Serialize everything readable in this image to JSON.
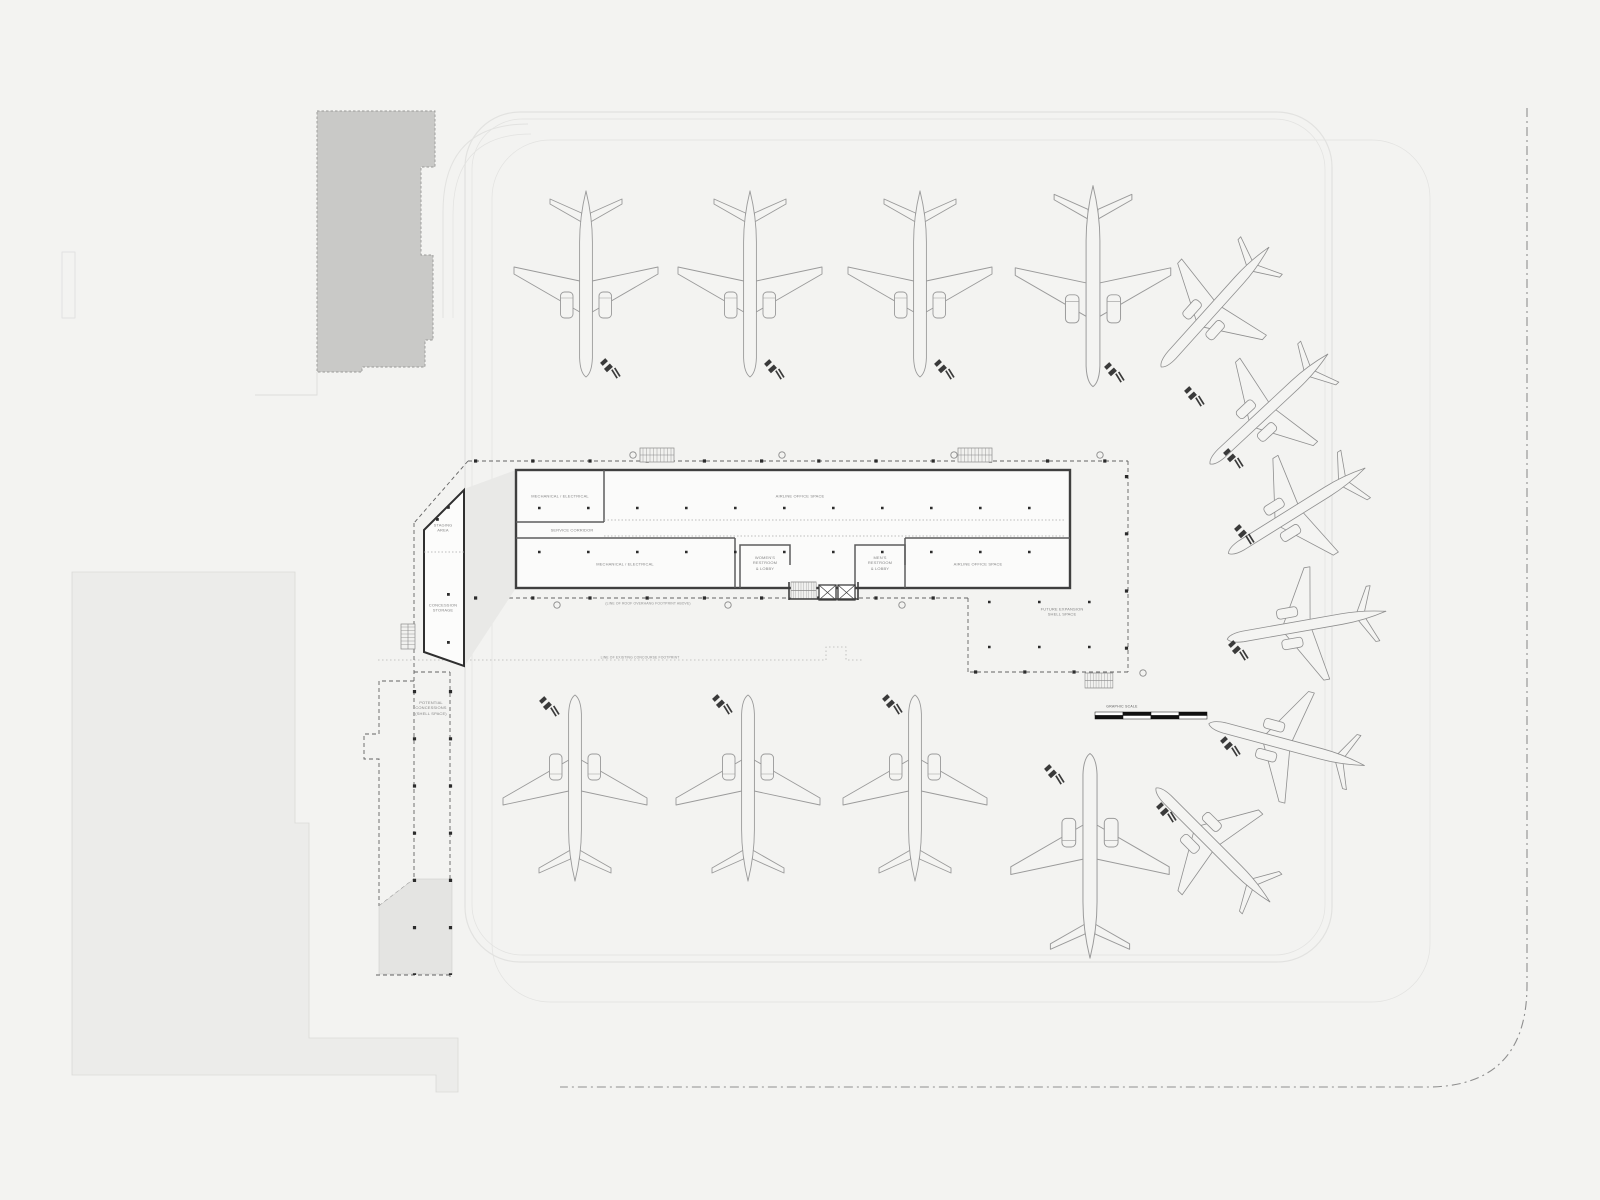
{
  "meta": {
    "drawing_type": "airport concourse apron site plan",
    "level": "plan view with parked aircraft"
  },
  "colors": {
    "background": "#f3f3f1",
    "landside_fill": "#ececea",
    "existing_building_fill": "#c9c9c7",
    "shell_fill": "#e4e4e2",
    "wall": "#3f3f3f",
    "canopy_dash": "#636363",
    "apron_line": "#e2e2e0",
    "aircraft_line": "#9a9a9a",
    "property_line": "#8f8f8f",
    "label_text": "#858585"
  },
  "labels": {
    "mech_elec_upper": "MECHANICAL / ELECTRICAL",
    "airline_office_upper": "AIRLINE OFFICE SPACE",
    "service_corridor": "SERVICE CORRIDOR",
    "mech_elec_lower": "MECHANICAL / ELECTRICAL",
    "womens_restroom": "WOMEN'S\nRESTROOM\n& LOBBY",
    "mens_restroom": "MEN'S\nRESTROOM\n& LOBBY",
    "airline_office_lower": "AIRLINE OFFICE SPACE",
    "future_expansion": "FUTURE EXPANSION\nSHELL SPACE",
    "staging_area": "STAGING\nAREA",
    "concession_storage": "CONCESSION\nSTORAGE",
    "potential_concessions": "POTENTIAL\nCONCESSIONS\n(SHELL SPACE)",
    "note_roof_overhang": "(LINE OF ROOF OVERHANG FOOTPRINT ABOVE)",
    "note_existing_concourse": "LINE OF EXISTING CONCOURSE FOOTPRINT",
    "graphic_scale": "GRAPHIC SCALE"
  },
  "aircraft": {
    "north_gates": [
      "widebody-north-1",
      "widebody-north-2",
      "widebody-north-3",
      "widebody-north-4"
    ],
    "east_remote_arc": [
      "narrowbody-east-1",
      "narrowbody-east-2",
      "narrowbody-east-3",
      "narrowbody-east-4",
      "narrowbody-east-5",
      "narrowbody-east-6"
    ],
    "south_gates": [
      "widebody-south-1",
      "widebody-south-2",
      "widebody-south-3",
      "widebody-south-4"
    ],
    "ground_equipment": "baggage-tug-with-carts at each aircraft nose"
  },
  "symbols": {
    "stairs": [
      "stair-north-1",
      "stair-north-2",
      "stair-core",
      "stair-west",
      "stair-southeast"
    ],
    "elevators": [
      "elevator-1",
      "elevator-2"
    ],
    "column_grid": "small square columns along canopy and walls, circle bubbles on grid"
  }
}
